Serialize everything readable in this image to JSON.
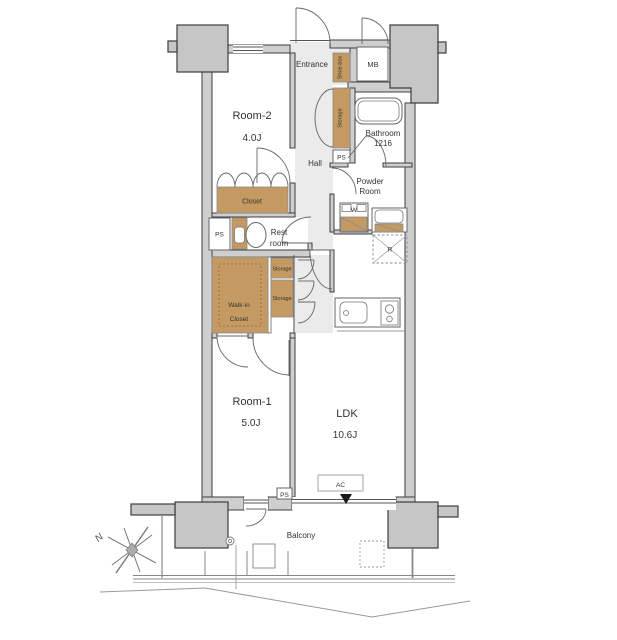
{
  "floorplan": {
    "rooms": {
      "room2": {
        "name": "Room-2",
        "size": "4.0J"
      },
      "room1": {
        "name": "Room-1",
        "size": "5.0J"
      },
      "ldk": {
        "name": "LDK",
        "size": "10.6J"
      },
      "entrance": "Entrance",
      "hall": "Hall",
      "powder": {
        "line1": "Powder",
        "line2": "Room"
      },
      "bathroom": {
        "name": "Bathroom",
        "size": "1216"
      },
      "restroom": {
        "line1": "Rest",
        "line2": "room"
      },
      "wic": {
        "line1": "Walk-in",
        "line2": "Closet"
      },
      "balcony": "Balcony"
    },
    "fixtures": {
      "shoe_box": "Shoe-box",
      "mb": "MB",
      "storage": "Storage",
      "ps": "PS",
      "closet": "Closet",
      "washer": "W",
      "fridge": "R",
      "ac": "AC"
    },
    "compass": {
      "north": "N"
    },
    "colors": {
      "wood": "#c49a62",
      "wall_fill": "#cfcfcf",
      "pillar_fill": "#c6c6c6",
      "line": "#3d3d3d",
      "hall_fill": "#ebebeb"
    }
  }
}
